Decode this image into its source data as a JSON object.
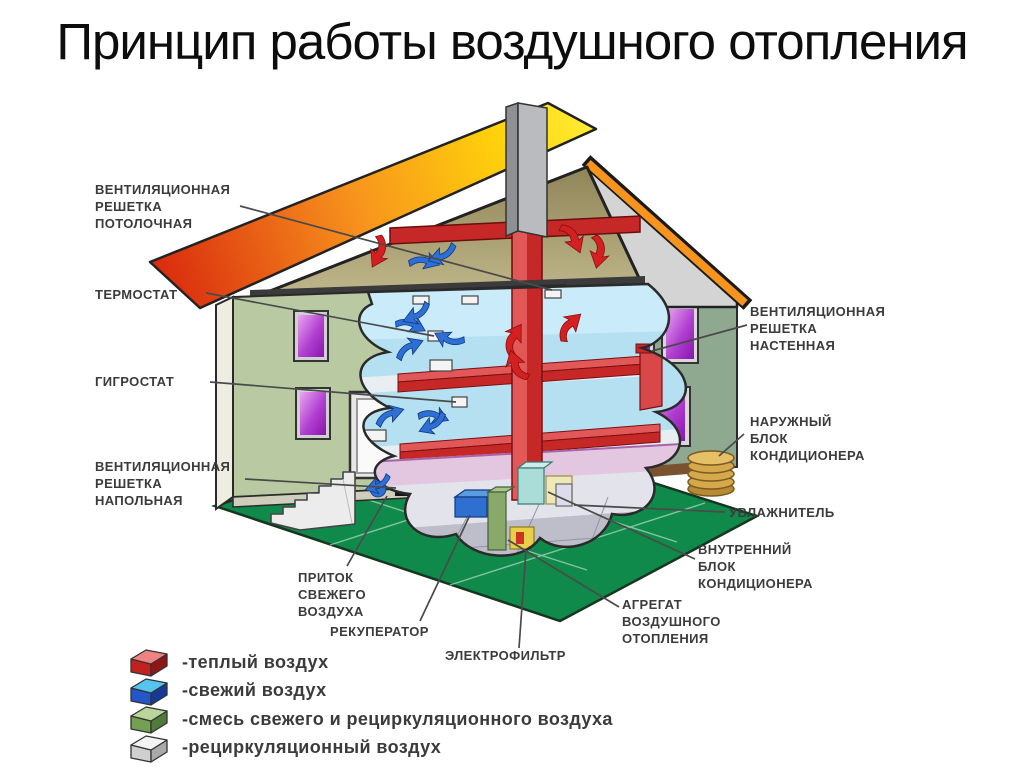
{
  "title": "Принцип работы воздушного отопления",
  "callouts": {
    "vent_ceiling": "ВЕНТИЛЯЦИОННАЯ\nРЕШЕТКА\nПОТОЛОЧНАЯ",
    "thermostat": "ТЕРМОСТАТ",
    "hygrostat": "ГИГРОСТАТ",
    "vent_floor": "ВЕНТИЛЯЦИОННАЯ\nРЕШЕТКА\nНАПОЛЬНАЯ",
    "fresh_air_intake": "ПРИТОК\nСВЕЖЕГО\nВОЗДУХА",
    "recuperator": "РЕКУПЕРАТОР",
    "electrofilter": "ЭЛЕКТРОФИЛЬТР",
    "vent_wall": "ВЕНТИЛЯЦИОННАЯ\nРЕШЕТКА\nНАСТЕННАЯ",
    "outdoor_ac_unit": "НАРУЖНЫЙ\nБЛОК\nКОНДИЦИОНЕРА",
    "humidifier": "УВЛАЖНИТЕЛЬ",
    "indoor_ac_unit": "ВНУТРЕННИЙ\nБЛОК\nКОНДИЦИОНЕРА",
    "air_heating_unit": "АГРЕГАТ\nВОЗДУШНОГО\nОТОПЛЕНИЯ"
  },
  "legend": {
    "items": [
      {
        "name": "warm-air",
        "label": "-теплый воздух",
        "colors": {
          "top": "#ef8383",
          "front": "#c32020",
          "side": "#8f1616"
        }
      },
      {
        "name": "fresh-air",
        "label": "-свежий воздух",
        "colors": {
          "top": "#55c4ef",
          "front": "#2356c8",
          "side": "#173a96"
        }
      },
      {
        "name": "mixed-air",
        "label": "-смесь свежего и рециркуляционного воздуха",
        "colors": {
          "top": "#b9d59b",
          "front": "#74a055",
          "side": "#4f7a3a"
        }
      },
      {
        "name": "recirculated-air",
        "label": "-рециркуляционный воздух",
        "colors": {
          "top": "#f3f3f3",
          "front": "#cfcfcf",
          "side": "#a9a9a9"
        }
      }
    ]
  },
  "illustration_colors": {
    "lawn": "#0f8a4b",
    "front_wall": "#b9c9a2",
    "side_wall": "#8ea990",
    "attic_tan": "#b2a87c",
    "roof_red": "#d92b0e",
    "roof_orange": "#f7941d",
    "roof_yellow": "#ffee3c",
    "duct_red": "#c62828",
    "duct_red_light": "#e25858",
    "interior_blue": "#b5e0f2",
    "window_purple_light": "#e9a6f0",
    "window_purple_dark": "#8a14b0",
    "leader_line": "#4a4a4a"
  }
}
